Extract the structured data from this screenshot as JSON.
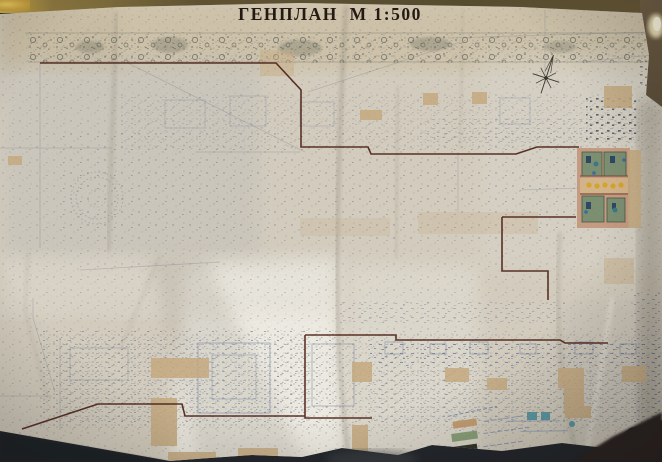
{
  "title": "ГЕНПЛАН  М 1:500",
  "scale": "1:500",
  "colors": {
    "paper": "#d6cfc0",
    "title_ink": "#241a12",
    "boundary_line": "#4d2015",
    "building_fill": "#c9ad83",
    "pencil": "#787e8c",
    "ink_blue": "#6b7aa0",
    "courtyard_pink": "#c79a7e",
    "courtyard_green": "#7f9274",
    "accent_yellow": "#d8a92c",
    "accent_teal": "#4a93a3",
    "background": "#23262c"
  },
  "legend": {
    "items": [
      {
        "name": "tan-swatch",
        "color": "#c9a175"
      },
      {
        "name": "green-swatch",
        "color": "#8ca37b"
      },
      {
        "name": "dark-swatch",
        "color": "#33362c"
      },
      {
        "name": "blue-oval-swatch",
        "color": "#3f7fc0"
      }
    ]
  },
  "compass": {
    "icon": "compass-rose"
  }
}
